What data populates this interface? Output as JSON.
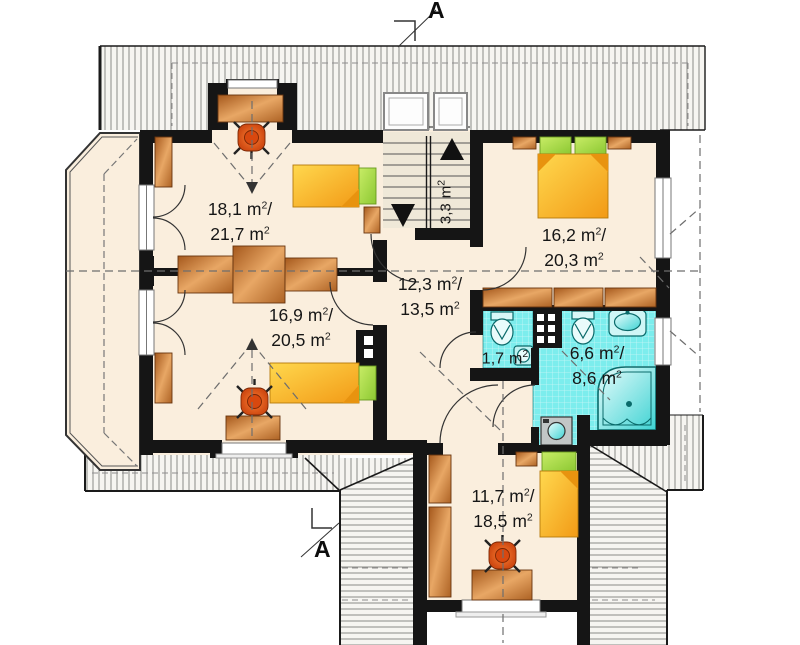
{
  "section_markers": {
    "label": "A"
  },
  "units": {
    "meter": "m",
    "exponent": "2",
    "separator": "/"
  },
  "rooms": [
    {
      "name": "room-upper-left",
      "floor_area": "18,1",
      "total_area": "21,7"
    },
    {
      "name": "bedroom-right",
      "floor_area": "16,2",
      "total_area": "20,3"
    },
    {
      "name": "hall",
      "floor_area": "12,3",
      "total_area": "13,5"
    },
    {
      "name": "room-lower-left",
      "floor_area": "16,9",
      "total_area": "20,5"
    },
    {
      "name": "wc",
      "floor_area": "1,7"
    },
    {
      "name": "bathroom",
      "floor_area": "6,6",
      "total_area": "8,6"
    },
    {
      "name": "room-bottom-wing",
      "floor_area": "11,7",
      "total_area": "18,5"
    },
    {
      "name": "staircase",
      "floor_area": "3,3"
    }
  ],
  "colors": {
    "wall": "#151515",
    "floor": "#faeedd",
    "bathroom_tile": "#7ceded",
    "roof_line": "#8b8b88",
    "wood": "#c97a33",
    "bed": "#f6a81c",
    "pillow": "#9ed23f",
    "chair": "#ef5a20",
    "fixture": "#52d8d8"
  }
}
